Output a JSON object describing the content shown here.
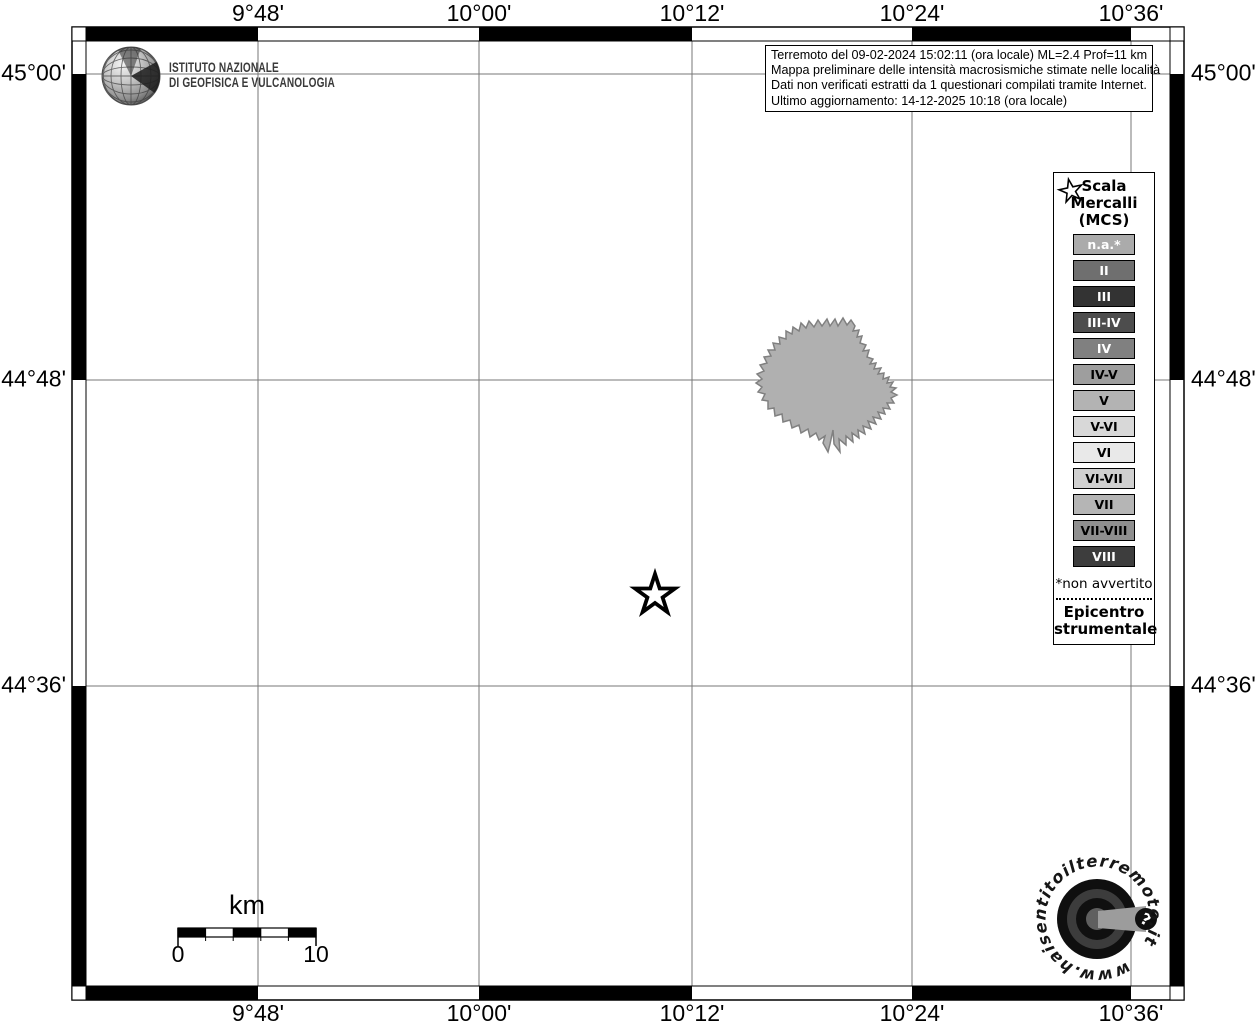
{
  "info_box": {
    "lines": [
      "Terremoto del 09-02-2024 15:02:11 (ora locale) ML=2.4 Prof=11 km",
      "Mappa preliminare delle intensità macrosismiche stimate nelle località",
      "Dati non verificati estratti da 1 questionari compilati tramite Internet.",
      "Ultimo aggiornamento: 14-12-2025 10:18 (ora locale)"
    ]
  },
  "branding": {
    "institute_line1": "ISTITUTO NAZIONALE",
    "institute_line2": "DI GEOFISICA E VULCANOLOGIA",
    "website": "www.haisentitoilterremoto.it",
    "question_mark": "?"
  },
  "axes": {
    "top": [
      "9°48'",
      "10°00'",
      "10°12'",
      "10°24'",
      "10°36'"
    ],
    "bottom": [
      "9°48'",
      "10°00'",
      "10°12'",
      "10°24'",
      "10°36'"
    ],
    "left": [
      "45°00'",
      "44°48'",
      "44°36'"
    ],
    "right": [
      "45°00'",
      "44°48'",
      "44°36'"
    ]
  },
  "legend": {
    "title_lines": [
      "Scala",
      "Mercalli",
      "(MCS)"
    ],
    "items": [
      {
        "label": "n.a.*",
        "color": "#ababab",
        "text_color": "#ffffff"
      },
      {
        "label": "II",
        "color": "#6f6f6f",
        "text_color": "#ffffff"
      },
      {
        "label": "III",
        "color": "#333333",
        "text_color": "#ffffff"
      },
      {
        "label": "III-IV",
        "color": "#4d4d4d",
        "text_color": "#ffffff"
      },
      {
        "label": "IV",
        "color": "#808080",
        "text_color": "#ffffff"
      },
      {
        "label": "IV-V",
        "color": "#9e9e9e",
        "text_color": "#000000"
      },
      {
        "label": "V",
        "color": "#b3b3b3",
        "text_color": "#000000"
      },
      {
        "label": "V-VI",
        "color": "#d8d8d8",
        "text_color": "#000000"
      },
      {
        "label": "VI",
        "color": "#e9e9e9",
        "text_color": "#000000"
      },
      {
        "label": "VI-VII",
        "color": "#d0d0d0",
        "text_color": "#000000"
      },
      {
        "label": "VII",
        "color": "#b5b5b5",
        "text_color": "#000000"
      },
      {
        "label": "VII-VIII",
        "color": "#8f8f8f",
        "text_color": "#000000"
      },
      {
        "label": "VIII",
        "color": "#3d3d3d",
        "text_color": "#ffffff"
      }
    ],
    "footnote": "*non avvertito",
    "epicenter_lines": [
      "Epicentro",
      "strumentale"
    ]
  },
  "scale_bar": {
    "unit": "km",
    "start_label": "0",
    "end_label": "10"
  },
  "map": {
    "municipality_fill": "#b0b0b0",
    "grid_color": "#777777"
  }
}
